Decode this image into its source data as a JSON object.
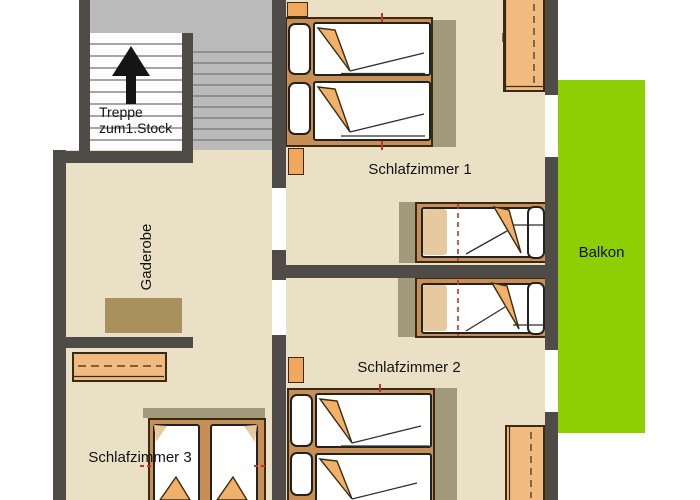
{
  "rooms": {
    "stairs": {
      "label_line1": "Treppe",
      "label_line2": "zum1.Stock"
    },
    "hallway": {
      "label": "Gaderobe"
    },
    "bedroom1": {
      "label": "Schlafzimmer 1"
    },
    "bedroom2": {
      "label": "Schlafzimmer 2"
    },
    "bedroom3": {
      "label": "Schlafzimmer 3"
    },
    "balcony": {
      "label": "Balkon"
    }
  },
  "icons": {
    "stairs_direction": "arrow-up"
  },
  "colors": {
    "wall": "#4f4b47",
    "floor": "#eae0c5",
    "stairs_area": "#bababa",
    "stair_line": "#a6a6a6",
    "balcony": "#8dcf02",
    "bed_frame": "#c78f55",
    "mattress": "#ffffff",
    "blanket": "#f1b169",
    "wardrobe": "#f1bb80",
    "nightstand": "#f1a75d",
    "shadow": "#a1997a",
    "dresser": "#a8915c",
    "outline": "#3b2a13",
    "center_line_red": "#c53426",
    "arrow": "#151515",
    "text": "#121212"
  }
}
